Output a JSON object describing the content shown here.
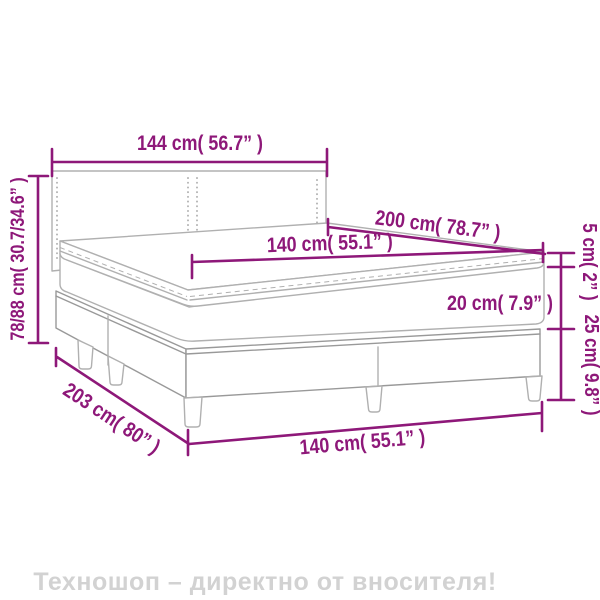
{
  "diagram": {
    "type": "box spring bed dimension line drawing",
    "labels": {
      "headboard_width": "144 cm( 56.7” )",
      "bed_height": "78/88 cm( 30.7/34.6” )",
      "bed_length": "200 cm( 78.7” )",
      "mattress_width": "140 cm( 55.1” )",
      "topper_height": "5 cm( 2” )",
      "mattress_height": "20 cm( 7.9” )",
      "base_height": "25 cm( 9.8” )",
      "base_length": "203 cm( 80” )",
      "base_width": "140 cm( 55.1” )"
    }
  },
  "watermark": {
    "text": "Техношоп – директно от вносителя!"
  },
  "colors": {
    "accent": "#8e1879",
    "bed_outline": "#b0b0b0",
    "bed_outline_dark": "#999999",
    "watermark": "#d2d2d2",
    "background": "#ffffff"
  }
}
